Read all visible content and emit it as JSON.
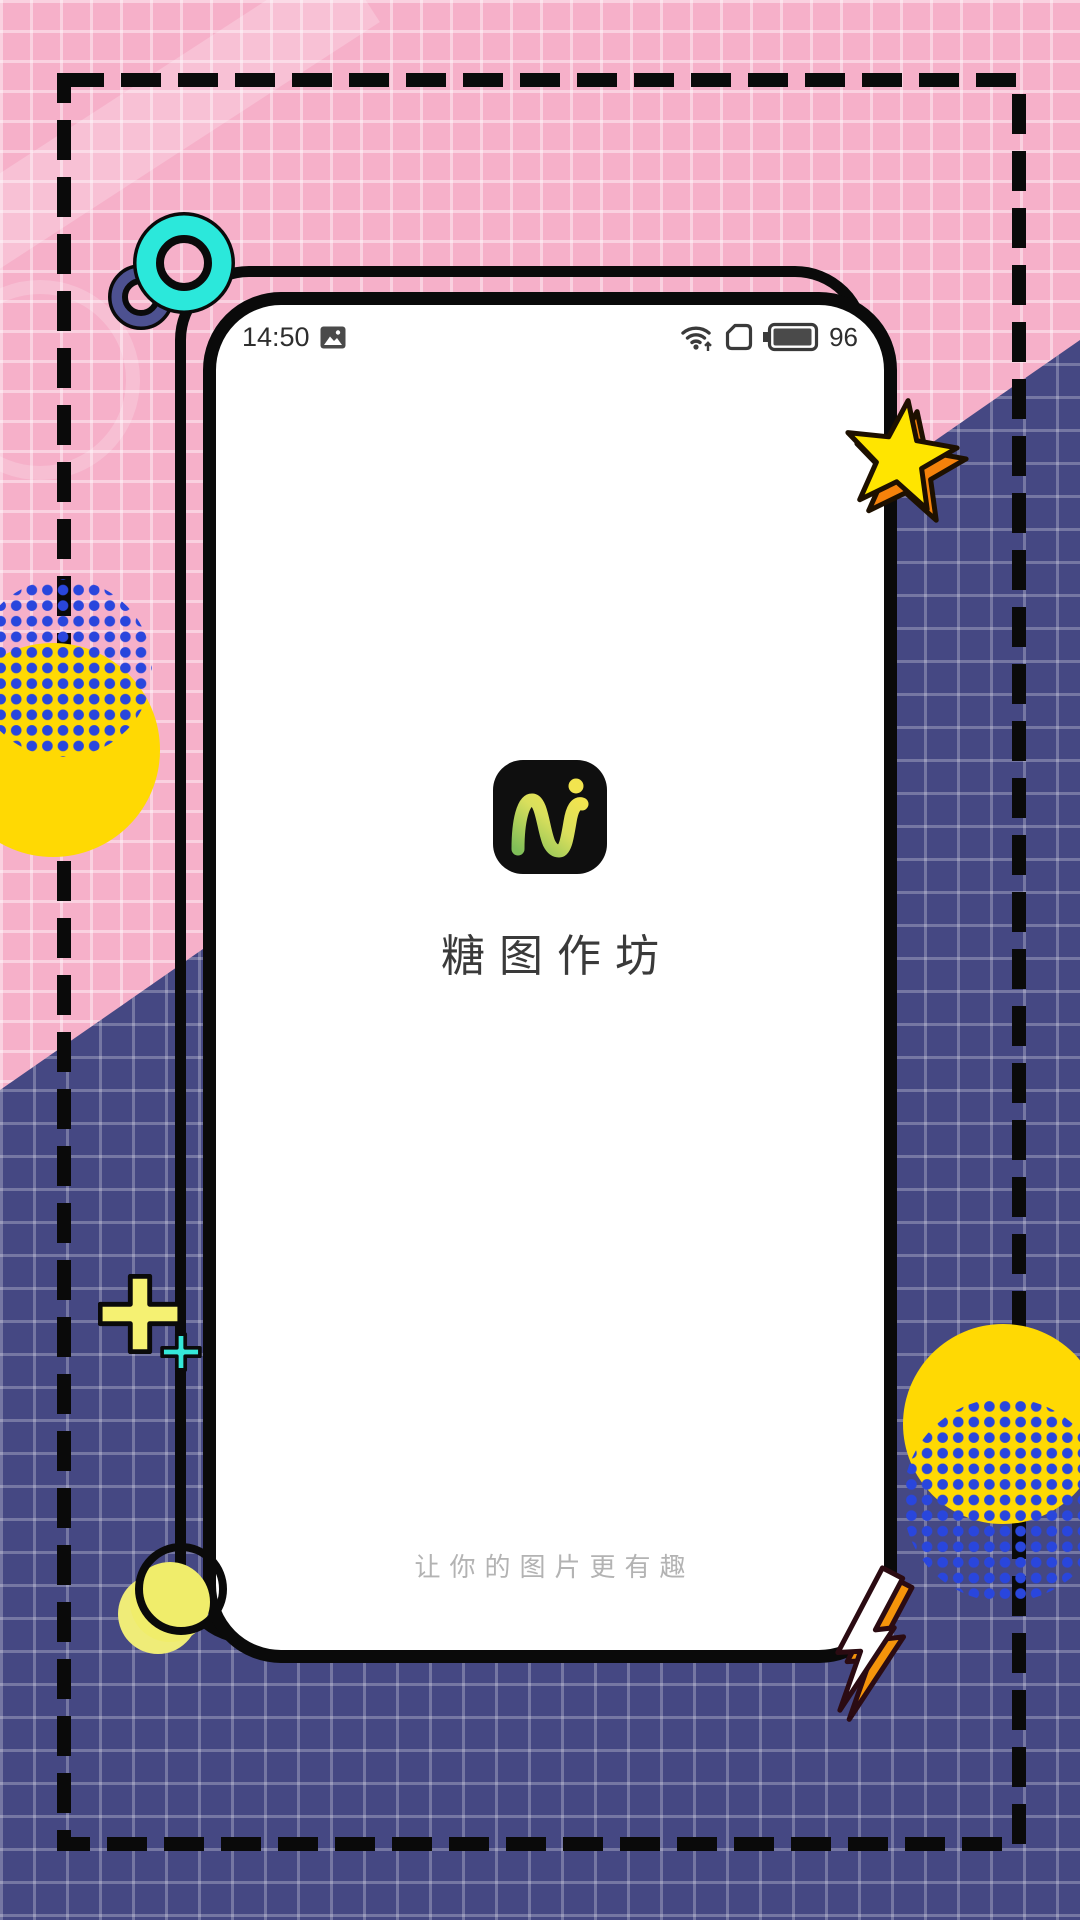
{
  "app": {
    "name": "糖图作坊",
    "tagline": "让你的图片更有趣"
  },
  "status_bar": {
    "time": "14:50",
    "battery_level": "96",
    "icons": [
      "photo-icon",
      "wifi-signal-icon",
      "sim-card-icon",
      "battery-icon"
    ]
  },
  "colors": {
    "pink_background": "#F6B0C9",
    "blue_background": "#454883",
    "golden_yellow": "#FFD903",
    "pale_yellow": "#F5F172",
    "teal": "#2BE8DB",
    "navy_ring": "#4D5190",
    "dot_blue": "#2946DD",
    "star_yellow": "#FFE500",
    "star_orange": "#F5820B",
    "app_icon_background": "#0F0F0F",
    "logo_gradient_start": "#7FBE58",
    "logo_gradient_end": "#F2E44F",
    "outline_black": "#0A0A0A"
  },
  "decorations": [
    "teal-ring",
    "navy-ring",
    "star-3d",
    "lightning-bolt-3d",
    "dotted-circle-left",
    "yellow-circle-left",
    "dotted-circle-bottom-right",
    "yellow-circle-bottom-right",
    "yellow-circle-corner",
    "black-ring-corner",
    "plus-large-yellow",
    "plus-small-cyan",
    "dashed-border-frame",
    "grid-pattern"
  ]
}
